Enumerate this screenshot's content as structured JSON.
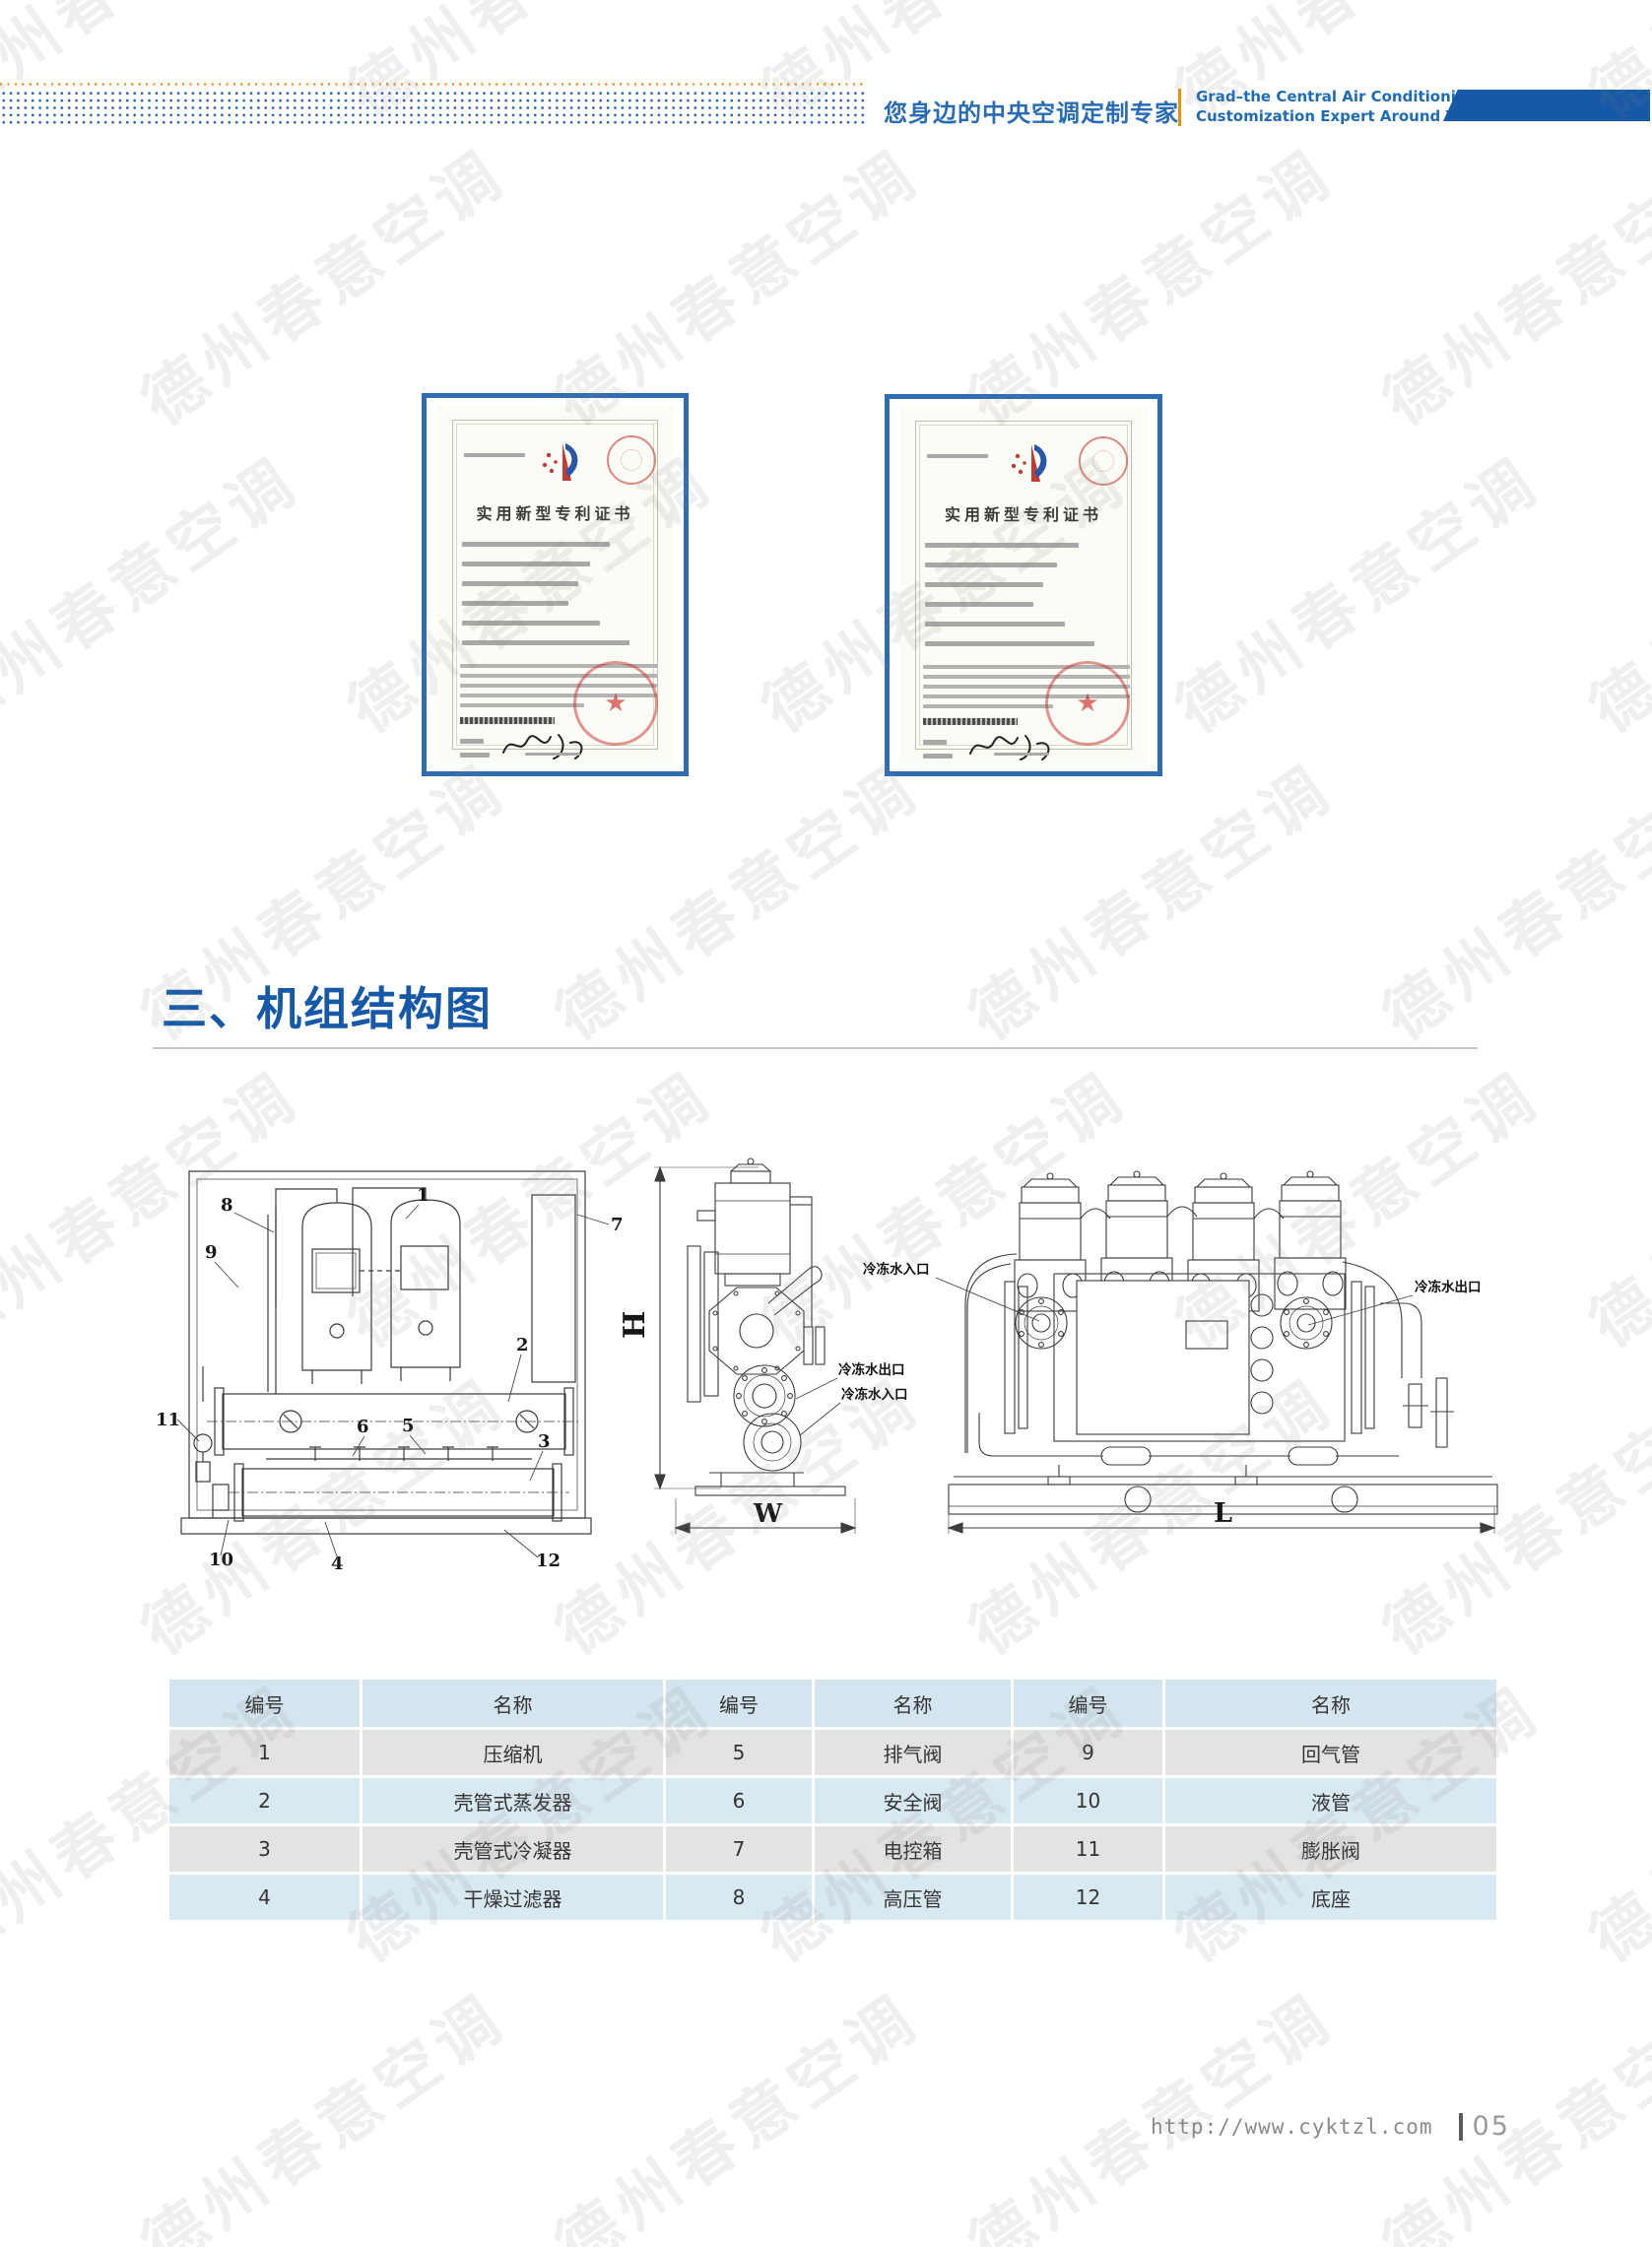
{
  "watermark": {
    "text": "德州春意空调"
  },
  "header": {
    "tagline_zh": "您身边的中央空调定制专家",
    "tagline_en_line1": "Grad–the Central Air Conditioning",
    "tagline_en_line2": "Customization Expert Around You",
    "accent_blue": "#1559a7",
    "accent_orange": "#e8930c"
  },
  "certificates": [
    {
      "title": "实用新型专利证书"
    },
    {
      "title": "实用新型专利证书"
    }
  ],
  "section": {
    "title": "三、机组结构图"
  },
  "diagram": {
    "labels": {
      "h": "H",
      "w": "W",
      "l": "L",
      "inlet": "冷冻水入口",
      "outlet": "冷冻水出口"
    },
    "callouts": [
      "1",
      "2",
      "3",
      "4",
      "5",
      "6",
      "7",
      "8",
      "9",
      "10",
      "11",
      "12"
    ]
  },
  "table": {
    "headers": [
      "编号",
      "名称",
      "编号",
      "名称",
      "编号",
      "名称"
    ],
    "rows": [
      [
        "1",
        "压缩机",
        "5",
        "排气阀",
        "9",
        "回气管"
      ],
      [
        "2",
        "壳管式蒸发器",
        "6",
        "安全阀",
        "10",
        "液管"
      ],
      [
        "3",
        "壳管式冷凝器",
        "7",
        "电控箱",
        "11",
        "膨胀阀"
      ],
      [
        "4",
        "干燥过滤器",
        "8",
        "高压管",
        "12",
        "底座"
      ]
    ]
  },
  "footer": {
    "url": "http://www.cyktzl.com",
    "page_number": "05"
  }
}
